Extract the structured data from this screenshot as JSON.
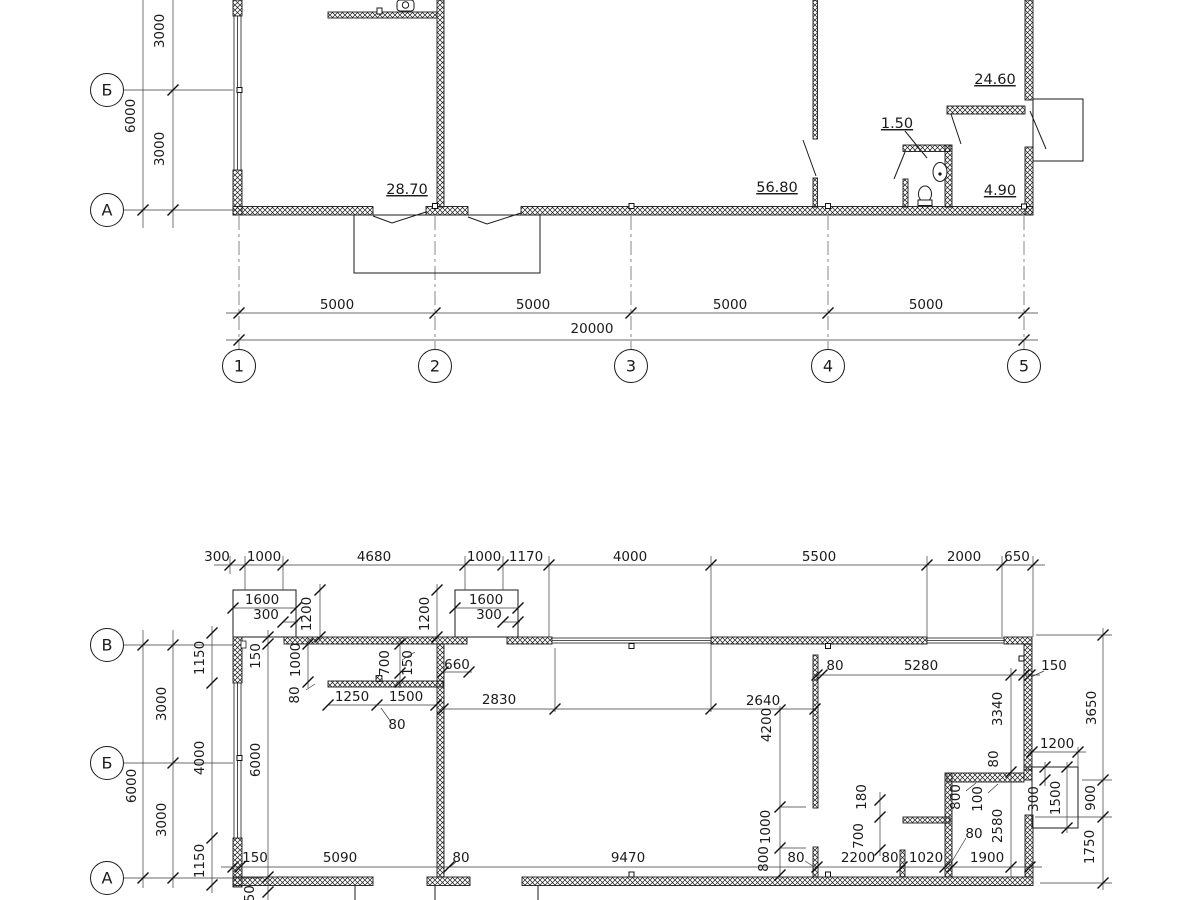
{
  "drawing": {
    "top_plan": {
      "row_axes": [
        "Б",
        "А"
      ],
      "col_axes": [
        "1",
        "2",
        "3",
        "4",
        "5"
      ],
      "left_dims": [
        "3000",
        "6000",
        "3000"
      ],
      "span_dims": [
        "5000",
        "5000",
        "5000",
        "5000"
      ],
      "total_dim": "20000",
      "room_areas": [
        "28.70",
        "56.80",
        "1.50",
        "24.60",
        "4.90"
      ]
    },
    "bottom_plan": {
      "row_axes": [
        "В",
        "Б",
        "А"
      ],
      "top_dims": [
        "300",
        "1000",
        "4680",
        "1000",
        "1170",
        "4000",
        "5500",
        "2000",
        "650"
      ],
      "porch_dims": [
        "1600",
        "300",
        "1200",
        "1200",
        "1600",
        "300"
      ],
      "left_dims": [
        "1150",
        "150",
        "1000",
        "80",
        "3000",
        "6000",
        "3000",
        "4000",
        "1150",
        "6000",
        "150"
      ],
      "lobby_dims": [
        "700",
        "150",
        "660",
        "1250",
        "1500",
        "2830",
        "80"
      ],
      "hall_dims": [
        "2640",
        "80",
        "5280",
        "150",
        "4200",
        "1000",
        "800"
      ],
      "wc_dims": [
        "180",
        "700",
        "800",
        "100",
        "80",
        "80"
      ],
      "right_dims": [
        "3340",
        "80",
        "1200",
        "300",
        "1500",
        "2580",
        "3650",
        "900",
        "1750"
      ],
      "bottom_dims": [
        "150",
        "5090",
        "80",
        "9470",
        "2200",
        "80",
        "1020",
        "1900"
      ]
    }
  }
}
